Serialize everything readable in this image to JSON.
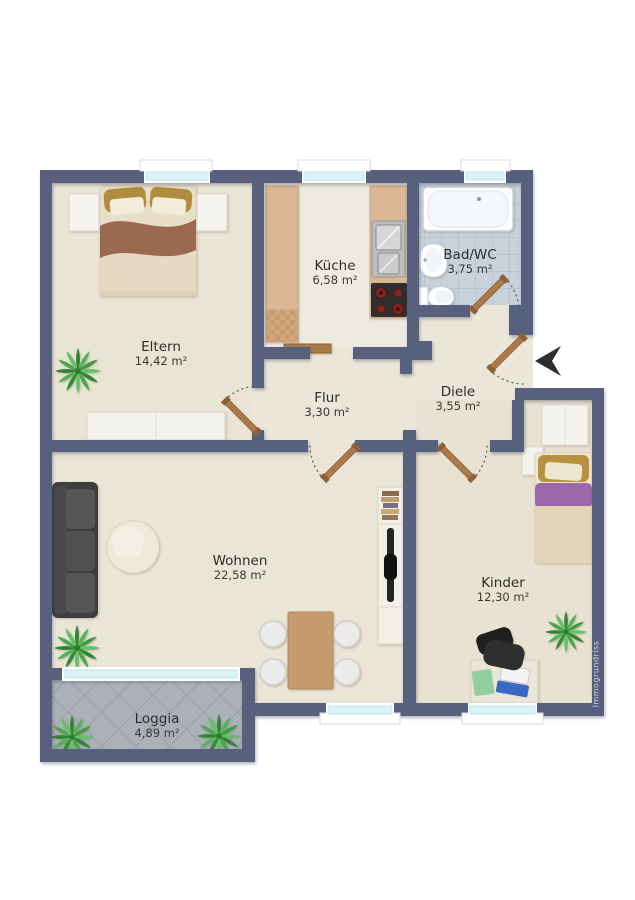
{
  "watermark": "Immogrundriss",
  "rooms": [
    {
      "id": "eltern",
      "name": "Eltern",
      "area": "14,42 m²"
    },
    {
      "id": "kueche",
      "name": "Küche",
      "area": "6,58 m²"
    },
    {
      "id": "bad",
      "name": "Bad/WC",
      "area": "3,75 m²"
    },
    {
      "id": "flur",
      "name": "Flur",
      "area": "3,30 m²"
    },
    {
      "id": "diele",
      "name": "Diele",
      "area": "3,55 m²"
    },
    {
      "id": "wohnen",
      "name": "Wohnen",
      "area": "22,58 m²"
    },
    {
      "id": "kinder",
      "name": "Kinder",
      "area": "12,30 m²"
    },
    {
      "id": "loggia",
      "name": "Loggia",
      "area": "4,89 m²"
    }
  ],
  "colors": {
    "wall": "#57617e",
    "floor": "#ebe6d9",
    "bath_tile": "#c8d2da",
    "loggia_tile": "#abb0b9",
    "window_glass": "#d9f3f9",
    "door_wood": "#aa7a4c",
    "plant_green": "#46a748",
    "sofa_gray": "#474747",
    "bed_blanket_brown": "#9b6950",
    "kid_blanket_purple": "#9c68aa",
    "counter_wood": "#dab896"
  }
}
